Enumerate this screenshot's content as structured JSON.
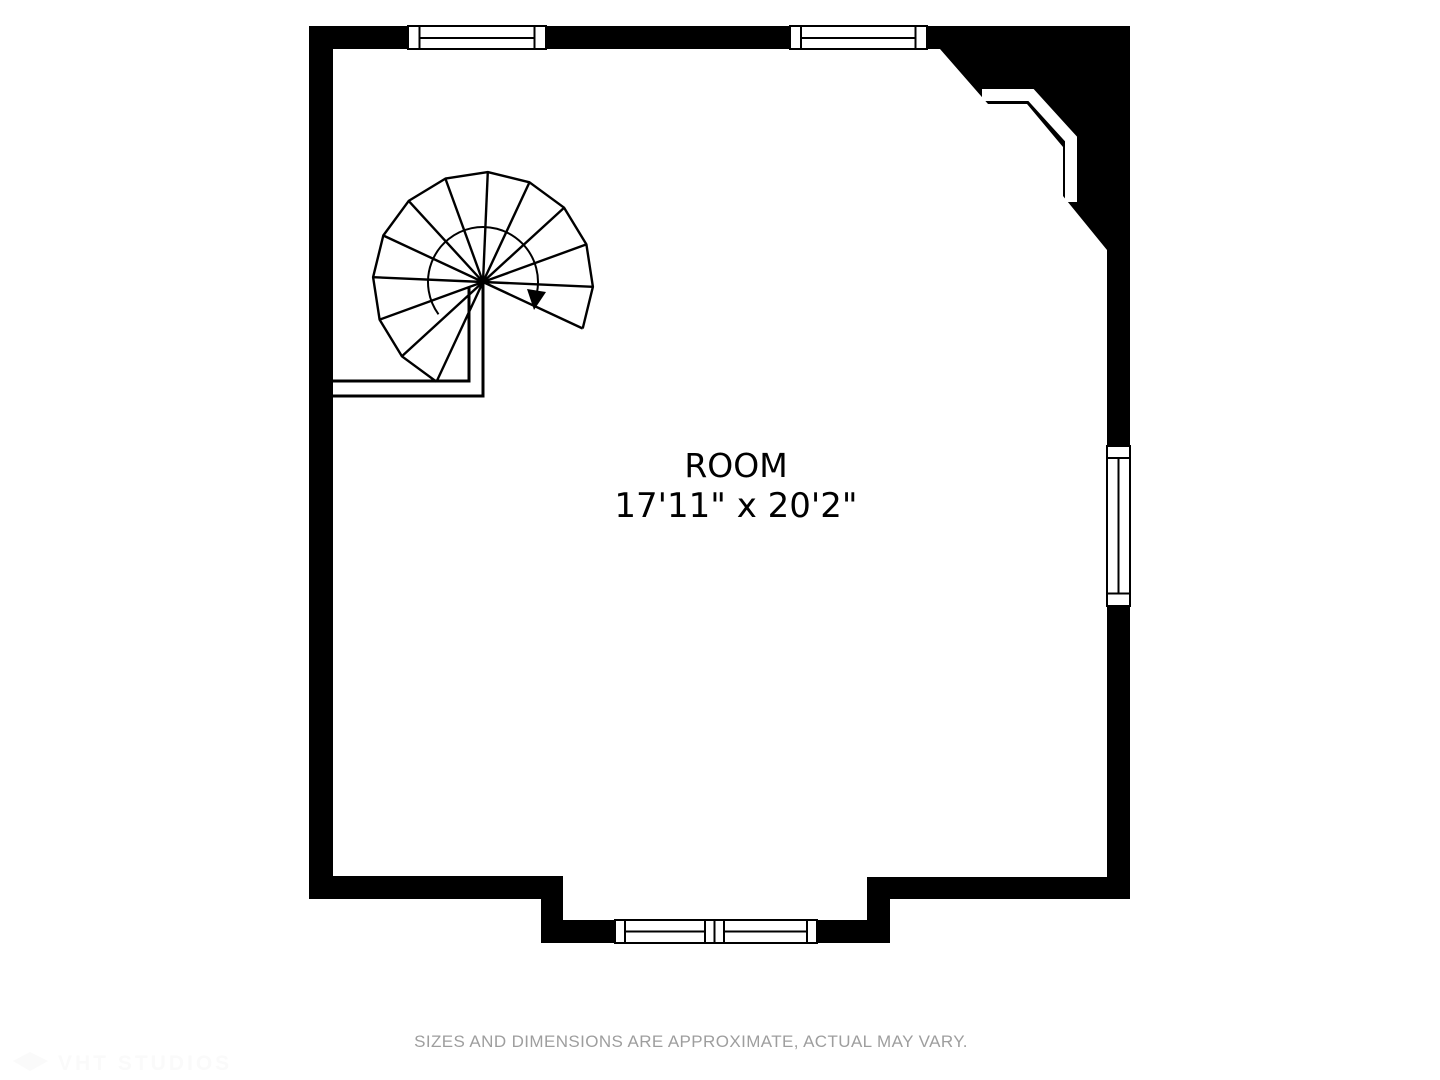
{
  "plan": {
    "room_label": "ROOM",
    "room_dimensions": "17'11\" x 20'2\""
  },
  "footer": {
    "disclaimer": "SIZES AND DIMENSIONS ARE APPROXIMATE, ACTUAL MAY VARY."
  },
  "watermark": {
    "text": "VHT STUDIOS"
  },
  "colors": {
    "wall": "#000000",
    "background": "#ffffff",
    "label_text": "#000000",
    "disclaimer_text": "#9e9e9e",
    "watermark_text": "#fafafa"
  }
}
